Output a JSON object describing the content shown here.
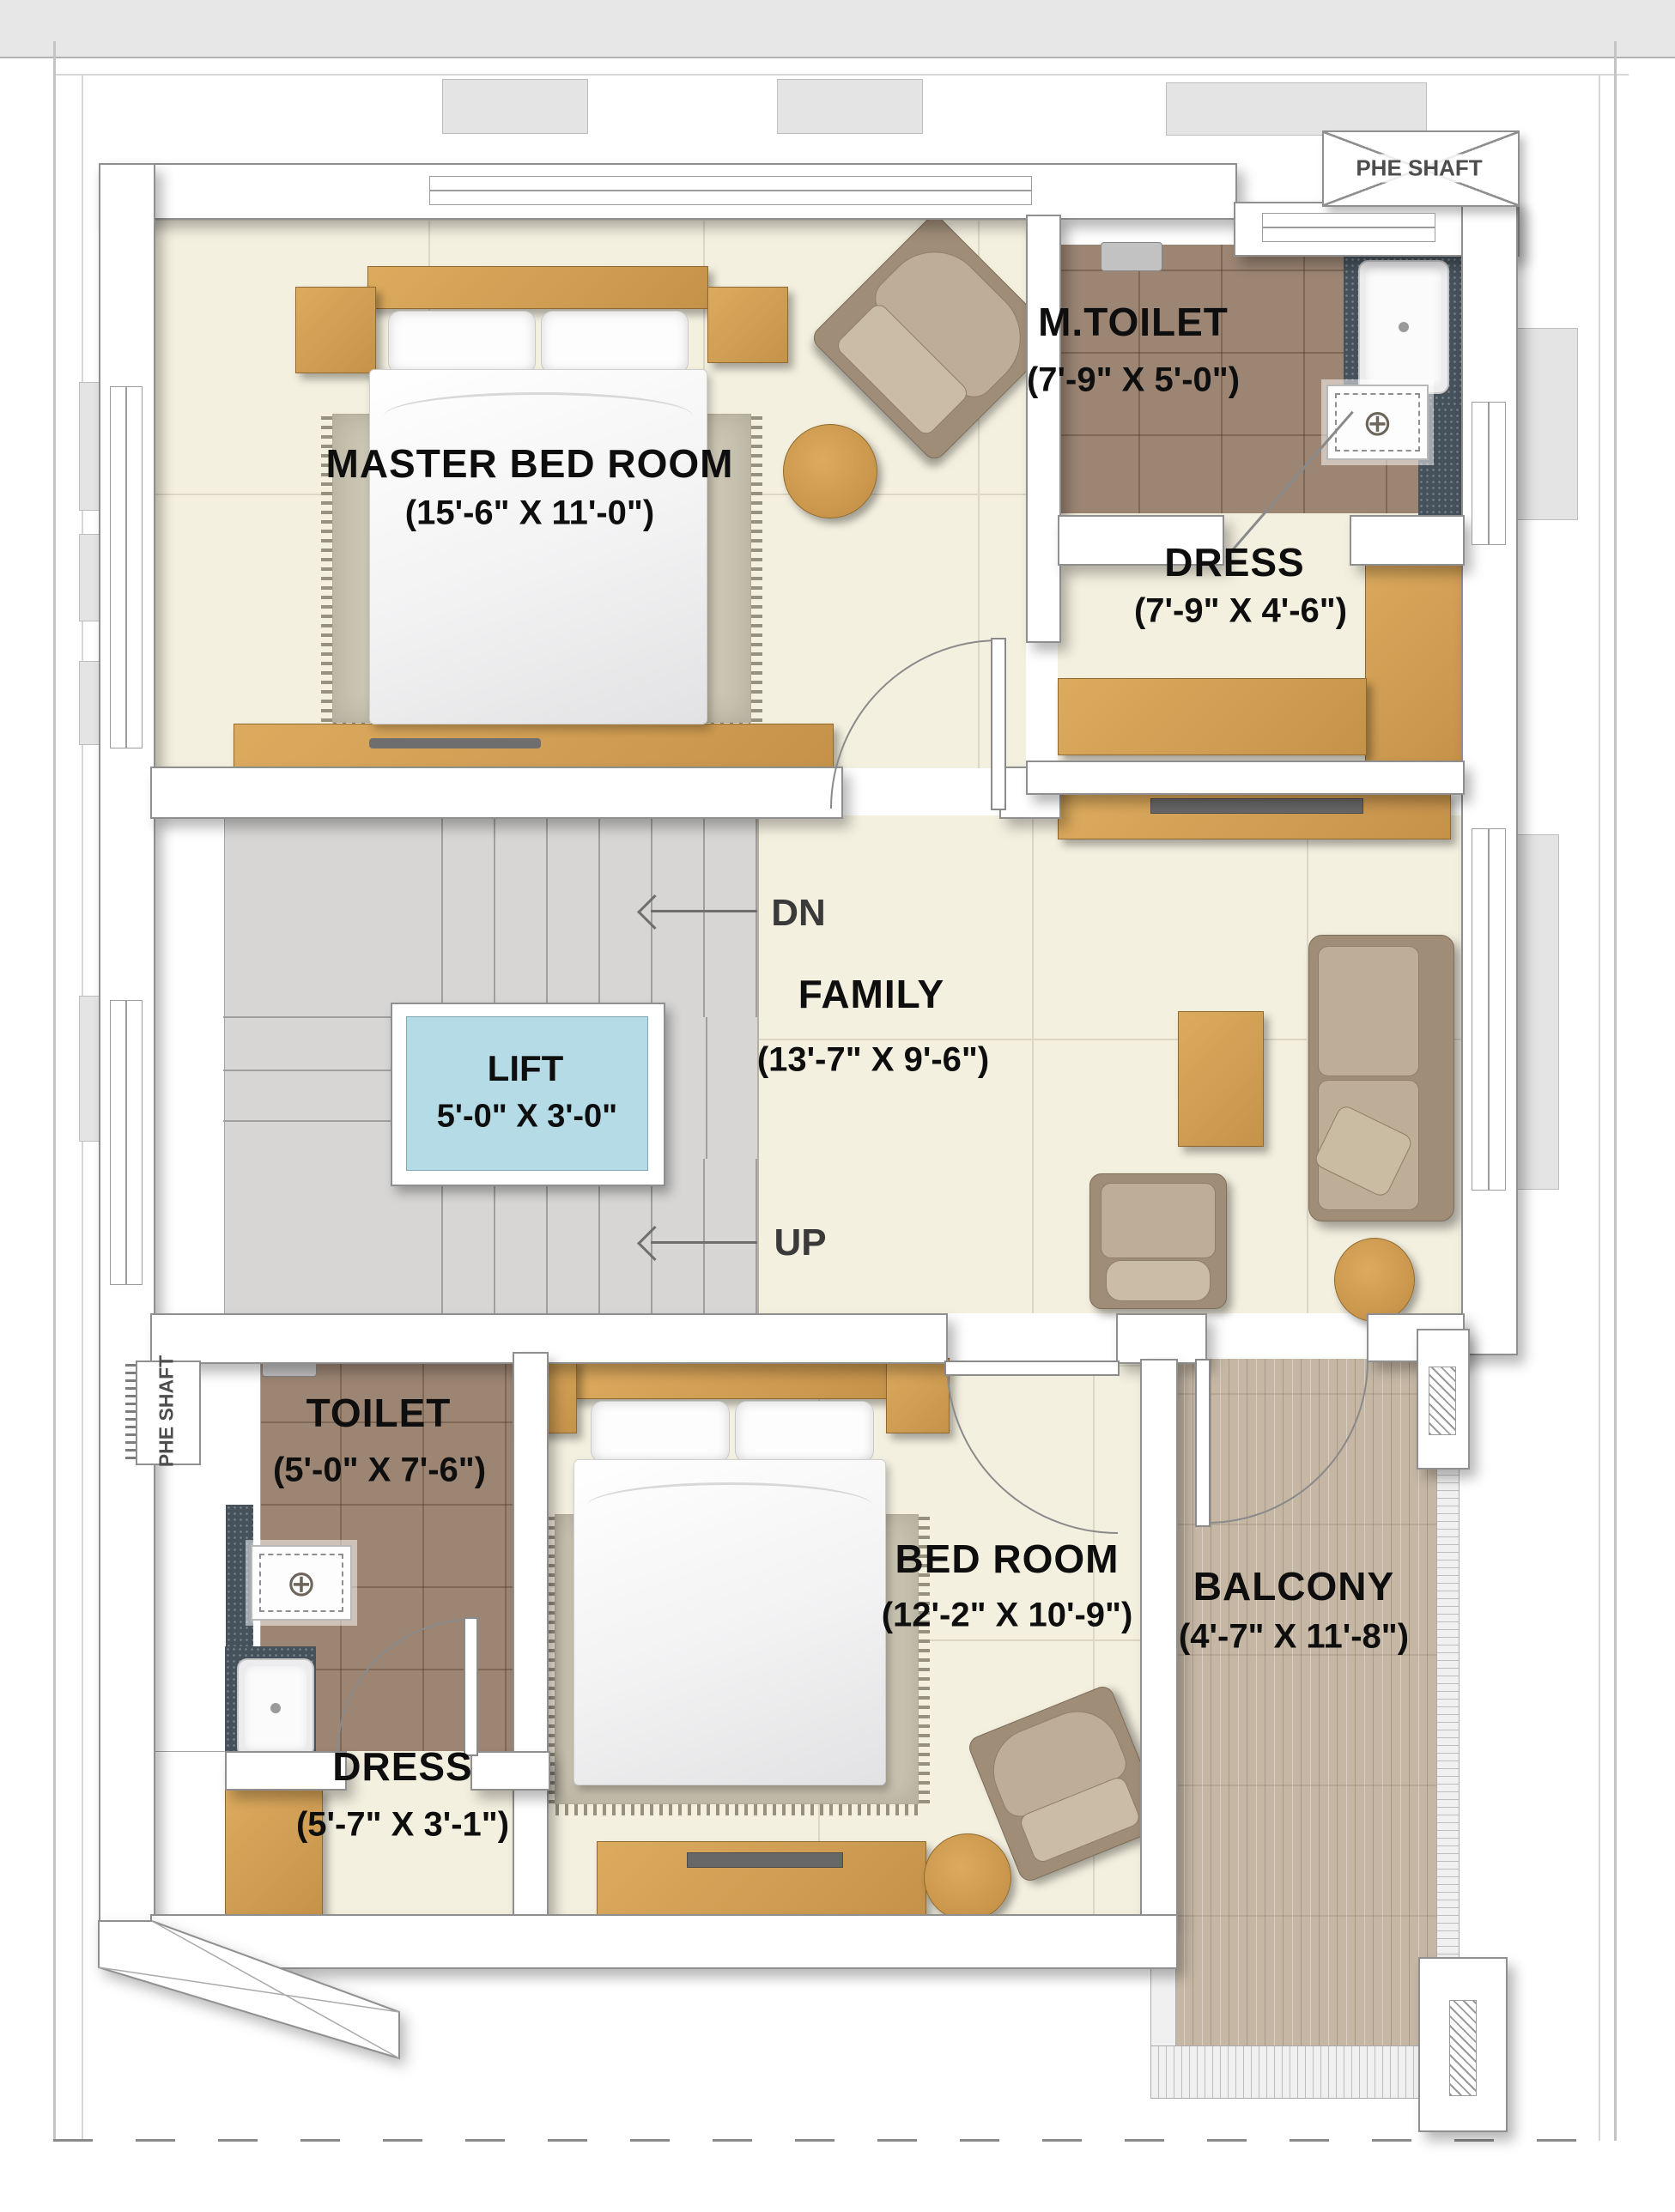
{
  "page": {
    "type": "architectural-floor-plan"
  },
  "colors": {
    "floor_cream": "#f4f0e0",
    "tile_brown": "#9c8573",
    "wood": "#d2a057",
    "lift_blue": "#b5dbe6",
    "stair_grey": "#d7d6d4",
    "balcony_wood": "#c5b7a4",
    "granite": "#45515b",
    "sofa_taupe": "#a08d78",
    "wall_outline": "#909090",
    "label_black": "#0e0e0e"
  },
  "rooms": {
    "master_bedroom": {
      "name": "MASTER BED ROOM",
      "dims": "(15'-6\" X 11'-0\")"
    },
    "m_toilet": {
      "name": "M.TOILET",
      "dims": "(7'-9\" X 5'-0\")"
    },
    "dress_top": {
      "name": "DRESS",
      "dims": "(7'-9\" X 4'-6\")"
    },
    "family": {
      "name": "FAMILY",
      "dims": "(13'-7\" X 9'-6\")"
    },
    "lift": {
      "name": "LIFT",
      "dims": "5'-0\" X 3'-0\""
    },
    "toilet": {
      "name": "TOILET",
      "dims": "(5'-0\" X 7'-6\")"
    },
    "bed_room": {
      "name": "BED ROOM",
      "dims": "(12'-2\" X 10'-9\")"
    },
    "balcony": {
      "name": "BALCONY",
      "dims": "(4'-7\" X 11'-8\")"
    },
    "dress_bottom": {
      "name": "DRESS",
      "dims": "(5'-7\" X 3'-1\")"
    }
  },
  "stairs": {
    "down": "DN",
    "up": "UP"
  },
  "shafts": {
    "top": "PHE SHAFT",
    "left": "PHE SHAFT"
  },
  "icons": {
    "shower_drain": "⊕"
  }
}
